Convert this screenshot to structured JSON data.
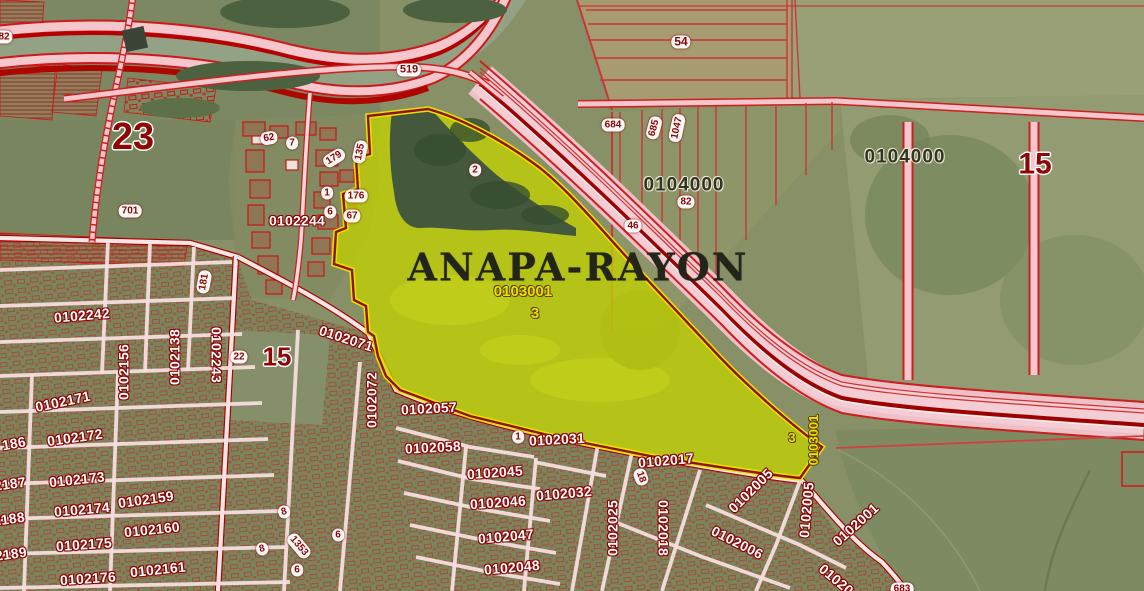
{
  "map": {
    "type": "cadastral-satellite-map",
    "title": "ANAPA-RAYON",
    "highlighted_parcel": {
      "quarter_code": "0103001",
      "parcel_number": "3"
    },
    "colors": {
      "parcel_highlight": "#c2d103",
      "boundary_red": "#cc1a1a",
      "road_pink": "#f5c6cc",
      "cadastral_label_fill": "#ffffff",
      "cadastral_label_outline": "#8c0404",
      "badge_text": "#8c0404",
      "big_label": "#8f0505",
      "yellow_label": "#f6dc00",
      "area_label": "#33331f"
    },
    "labels": [
      {
        "text": "82",
        "x": 4,
        "y": 37,
        "style": "badge"
      },
      {
        "text": "519",
        "x": 409,
        "y": 70,
        "style": "badge",
        "size": 11
      },
      {
        "text": "54",
        "x": 681,
        "y": 42,
        "style": "badge",
        "size": 12
      },
      {
        "text": "684",
        "x": 613,
        "y": 125,
        "style": "badge"
      },
      {
        "text": "685",
        "x": 654,
        "y": 128,
        "style": "badge",
        "rot": -75
      },
      {
        "text": "1047",
        "x": 677,
        "y": 128,
        "style": "badge",
        "rot": -78
      },
      {
        "text": "82",
        "x": 686,
        "y": 202,
        "style": "badge"
      },
      {
        "text": "46",
        "x": 633,
        "y": 226,
        "style": "badge"
      },
      {
        "text": "701",
        "x": 130,
        "y": 211,
        "style": "badge"
      },
      {
        "text": "62",
        "x": 269,
        "y": 138,
        "style": "badge",
        "rot": -10
      },
      {
        "text": "7",
        "x": 292,
        "y": 143,
        "style": "badge"
      },
      {
        "text": "179",
        "x": 334,
        "y": 158,
        "style": "badge",
        "rot": -32
      },
      {
        "text": "135",
        "x": 360,
        "y": 152,
        "style": "badge",
        "rot": -78
      },
      {
        "text": "1",
        "x": 327,
        "y": 193,
        "style": "badge"
      },
      {
        "text": "176",
        "x": 356,
        "y": 196,
        "style": "badge"
      },
      {
        "text": "6",
        "x": 330,
        "y": 212,
        "style": "badge"
      },
      {
        "text": "67",
        "x": 352,
        "y": 216,
        "style": "badge"
      },
      {
        "text": "2",
        "x": 475,
        "y": 170,
        "style": "badge"
      },
      {
        "text": "181",
        "x": 204,
        "y": 282,
        "style": "badge",
        "rot": -80
      },
      {
        "text": "22",
        "x": 239,
        "y": 357,
        "style": "badge"
      },
      {
        "text": "1",
        "x": 518,
        "y": 437,
        "style": "badge"
      },
      {
        "text": "18",
        "x": 641,
        "y": 477,
        "style": "badge",
        "rot": 70
      },
      {
        "text": "8",
        "x": 284,
        "y": 512,
        "style": "badge",
        "rot": -15
      },
      {
        "text": "8",
        "x": 262,
        "y": 549,
        "style": "badge",
        "rot": -15
      },
      {
        "text": "1353",
        "x": 299,
        "y": 546,
        "style": "badge",
        "rot": 50
      },
      {
        "text": "6",
        "x": 338,
        "y": 535,
        "style": "badge"
      },
      {
        "text": "6",
        "x": 297,
        "y": 570,
        "style": "badge"
      },
      {
        "text": "683",
        "x": 902,
        "y": 589,
        "style": "badge"
      },
      {
        "text": "23",
        "x": 133,
        "y": 138,
        "style": "big",
        "size": 38
      },
      {
        "text": "15",
        "x": 1035,
        "y": 164,
        "style": "big",
        "size": 30
      },
      {
        "text": "15",
        "x": 277,
        "y": 357,
        "style": "big",
        "size": 26
      },
      {
        "text": "0104000",
        "x": 684,
        "y": 186,
        "style": "area"
      },
      {
        "text": "0104000",
        "x": 905,
        "y": 158,
        "style": "area"
      },
      {
        "text": "0102244",
        "x": 297,
        "y": 221,
        "style": "block"
      },
      {
        "text": "0102242",
        "x": 82,
        "y": 316,
        "style": "block",
        "rot": -5
      },
      {
        "text": "0102156",
        "x": 124,
        "y": 372,
        "style": "block",
        "rot": -90
      },
      {
        "text": "0102138",
        "x": 175,
        "y": 357,
        "style": "block",
        "rot": -90
      },
      {
        "text": "0102243",
        "x": 216,
        "y": 355,
        "style": "block",
        "rot": 90
      },
      {
        "text": "0102171",
        "x": 63,
        "y": 402,
        "style": "block",
        "rot": -12
      },
      {
        "text": "0102172",
        "x": 75,
        "y": 438,
        "style": "block",
        "rot": -8
      },
      {
        "text": "0102173",
        "x": 77,
        "y": 480,
        "style": "block",
        "rot": -6
      },
      {
        "text": "0102174",
        "x": 82,
        "y": 510,
        "style": "block",
        "rot": -5
      },
      {
        "text": "0102175",
        "x": 84,
        "y": 545,
        "style": "block",
        "rot": -4
      },
      {
        "text": "0102176",
        "x": 88,
        "y": 579,
        "style": "block",
        "rot": -4
      },
      {
        "text": "186",
        "x": 14,
        "y": 444,
        "style": "block",
        "rot": -10
      },
      {
        "text": "02187",
        "x": 6,
        "y": 485,
        "style": "block",
        "rot": -8
      },
      {
        "text": "02188",
        "x": 5,
        "y": 520,
        "style": "block",
        "rot": -8
      },
      {
        "text": "02189",
        "x": 7,
        "y": 555,
        "style": "block",
        "rot": -8
      },
      {
        "text": "0102159",
        "x": 146,
        "y": 500,
        "style": "block",
        "rot": -8
      },
      {
        "text": "0102160",
        "x": 152,
        "y": 530,
        "style": "block",
        "rot": -6
      },
      {
        "text": "0102161",
        "x": 158,
        "y": 570,
        "style": "block",
        "rot": -6
      },
      {
        "text": "0102071",
        "x": 346,
        "y": 339,
        "style": "block",
        "rot": 18
      },
      {
        "text": "0102072",
        "x": 372,
        "y": 400,
        "style": "block",
        "rot": -90
      },
      {
        "text": "0102057",
        "x": 429,
        "y": 409,
        "style": "block",
        "rot": -3
      },
      {
        "text": "0102058",
        "x": 433,
        "y": 448,
        "style": "block",
        "rot": -3
      },
      {
        "text": "0102045",
        "x": 495,
        "y": 473,
        "style": "block",
        "rot": -4
      },
      {
        "text": "0102031",
        "x": 557,
        "y": 440,
        "style": "block",
        "rot": -3
      },
      {
        "text": "0102046",
        "x": 498,
        "y": 503,
        "style": "block",
        "rot": -4
      },
      {
        "text": "0102032",
        "x": 564,
        "y": 494,
        "style": "block",
        "rot": -5
      },
      {
        "text": "0102047",
        "x": 506,
        "y": 537,
        "style": "block",
        "rot": -5
      },
      {
        "text": "0102048",
        "x": 512,
        "y": 568,
        "style": "block",
        "rot": -5
      },
      {
        "text": "0102017",
        "x": 666,
        "y": 461,
        "style": "block",
        "rot": -5
      },
      {
        "text": "0102025",
        "x": 613,
        "y": 528,
        "style": "block",
        "rot": -90
      },
      {
        "text": "0102018",
        "x": 663,
        "y": 528,
        "style": "block",
        "rot": 90
      },
      {
        "text": "0102005",
        "x": 751,
        "y": 491,
        "style": "block",
        "rot": -45
      },
      {
        "text": "0102005",
        "x": 807,
        "y": 510,
        "style": "block",
        "rot": -85
      },
      {
        "text": "0102006",
        "x": 737,
        "y": 543,
        "style": "block",
        "rot": 27
      },
      {
        "text": "0102001",
        "x": 856,
        "y": 525,
        "style": "block",
        "rot": -42
      },
      {
        "text": "01020",
        "x": 836,
        "y": 580,
        "style": "block",
        "rot": 40
      },
      {
        "text": "0103001",
        "x": 523,
        "y": 292,
        "style": "yellow"
      },
      {
        "text": "3",
        "x": 535,
        "y": 314,
        "style": "yellow"
      },
      {
        "text": "0103001",
        "x": 814,
        "y": 440,
        "style": "yellow",
        "size": 13,
        "rot": -90
      },
      {
        "text": "3",
        "x": 792,
        "y": 438,
        "style": "yellow",
        "size": 13
      }
    ]
  }
}
